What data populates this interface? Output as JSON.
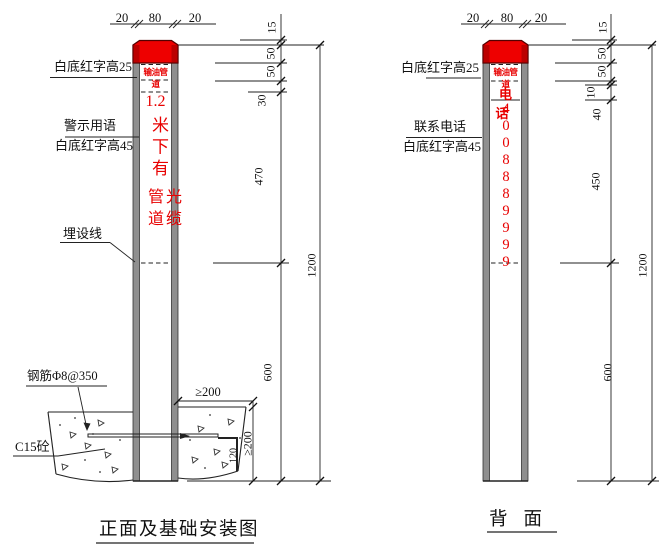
{
  "front_view": {
    "title": "正面及基础安装图",
    "top_dims": {
      "left": "20",
      "mid": "80",
      "right": "20"
    },
    "annotations": {
      "cap_note": "白底红字高25",
      "warn_note1": "警示用语",
      "warn_note2": "白底红字高45",
      "burial": "埋设线",
      "rebar": "钢筋Φ8@350",
      "concrete": "C15砼"
    },
    "post": {
      "band": "输油管道",
      "warn_line1": "1.2",
      "warn_col": "米下有",
      "warn_col_left": "管道",
      "warn_col_right": "光缆"
    },
    "dims": {
      "d15": "15",
      "d50a": "50",
      "d50b": "50",
      "d30": "30",
      "d470": "470",
      "d600": "600",
      "d1200": "1200",
      "dmin200h": "≥200",
      "dmin200v": "≥200",
      "d120": "120"
    }
  },
  "back_view": {
    "title": "背面",
    "top_dims": {
      "left": "20",
      "mid": "80",
      "right": "20"
    },
    "annotations": {
      "cap_note": "白底红字高25",
      "contact1": "联系电话",
      "contact2": "白底红字高45"
    },
    "post": {
      "band": "输油管道",
      "phone_label": "电话",
      "phone_number": "4008889999"
    },
    "dims": {
      "d15": "15",
      "d50a": "50",
      "d50b": "50",
      "d10": "10",
      "d40": "40",
      "d450": "450",
      "d600": "600",
      "d1200": "1200"
    }
  },
  "colors": {
    "warning_red": "#e80000",
    "cap_red": "#ee0000",
    "line": "#1a1a1a"
  }
}
